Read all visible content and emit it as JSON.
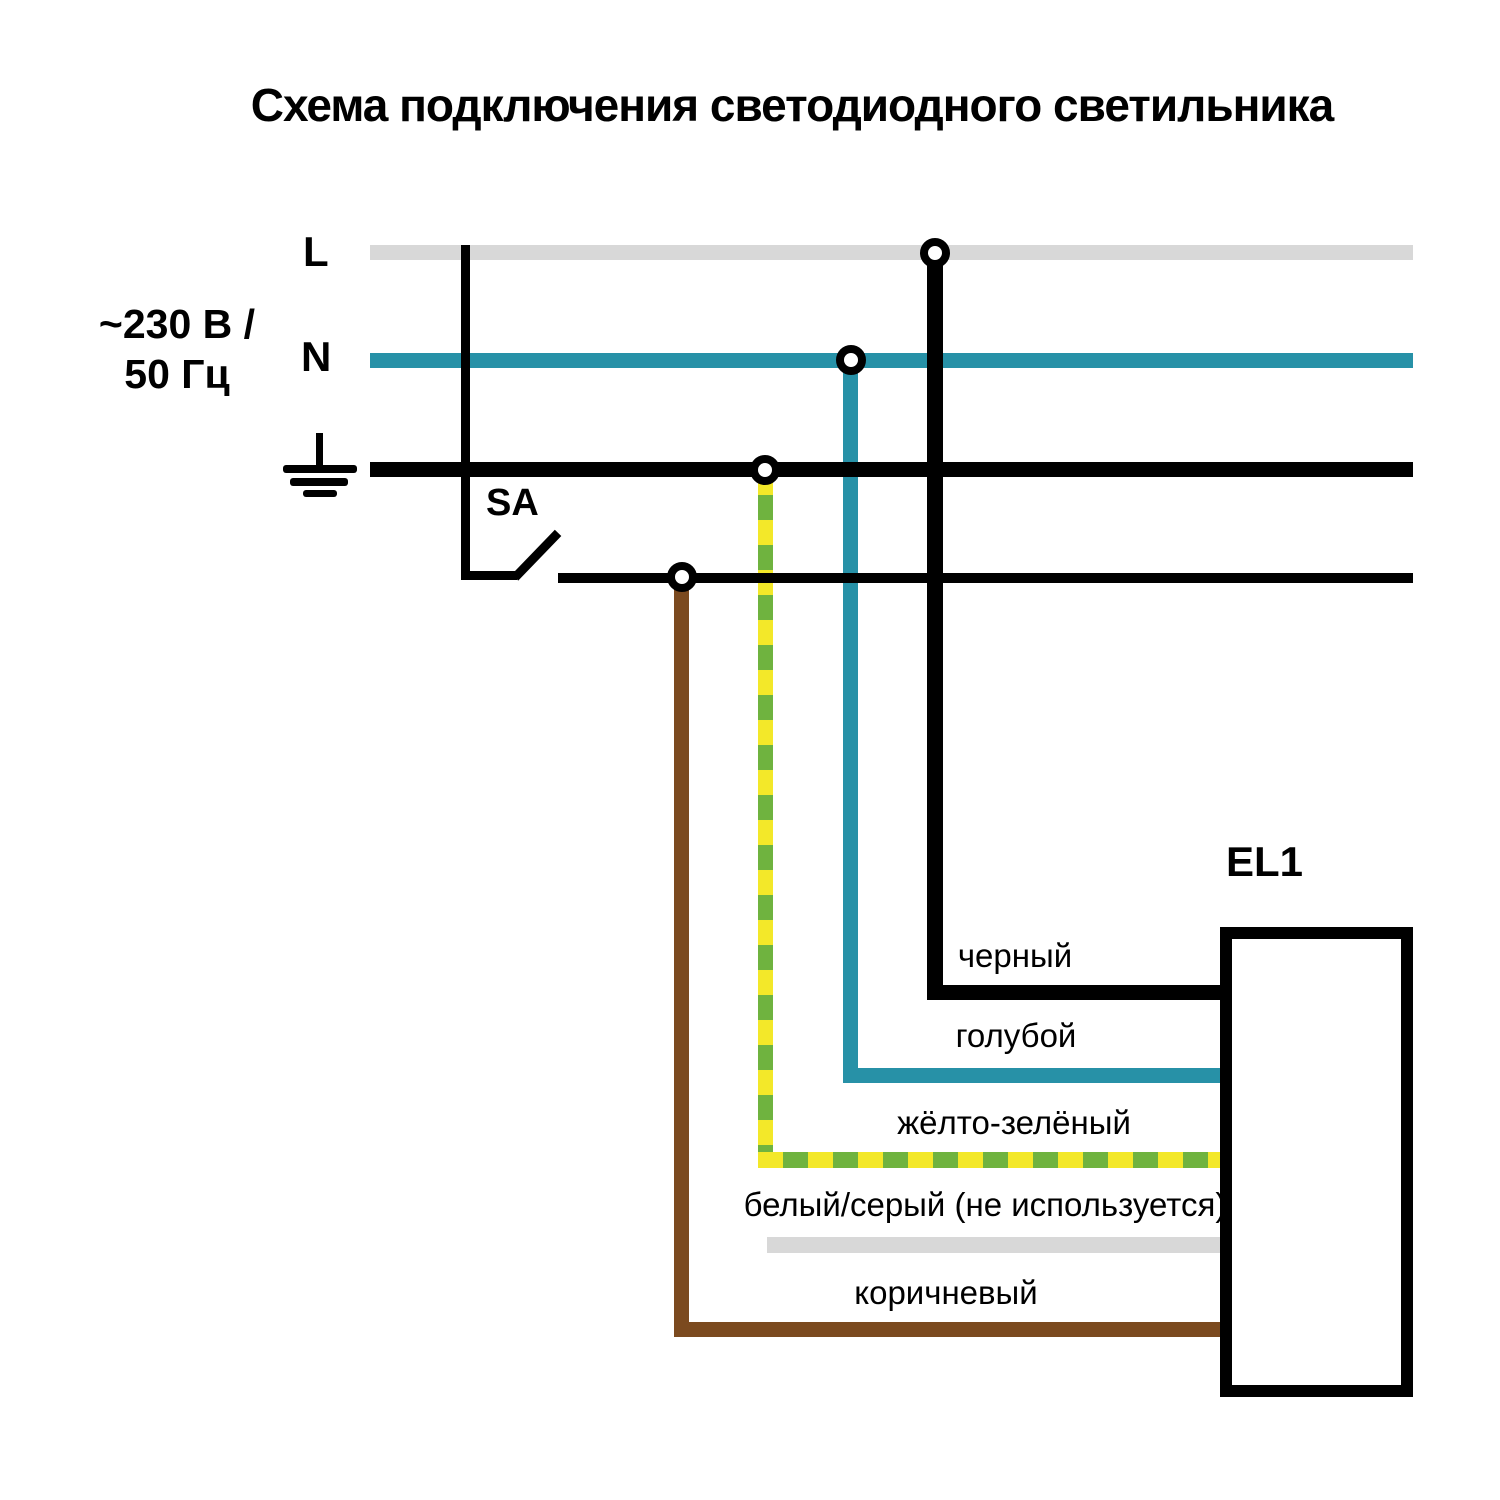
{
  "title": "Схема подключения светодиодного светильника",
  "power_source": {
    "line_label": "L",
    "neutral_label": "N",
    "voltage": "~230 В /",
    "frequency": "50 Гц"
  },
  "switch": {
    "label": "SA"
  },
  "luminaire": {
    "label": "EL1"
  },
  "wires": {
    "black": {
      "label": "черный",
      "color": "#000000"
    },
    "blue": {
      "label": "голубой",
      "color": "#2791A7"
    },
    "yellow_green": {
      "label": "жёлто-зелёный",
      "color_yellow": "#F3E829",
      "color_green": "#6FB33F"
    },
    "white_gray": {
      "label": "белый/серый (не используется)",
      "color": "#D8D8D8"
    },
    "brown": {
      "label": "коричневый",
      "color": "#7B4A1F"
    }
  }
}
